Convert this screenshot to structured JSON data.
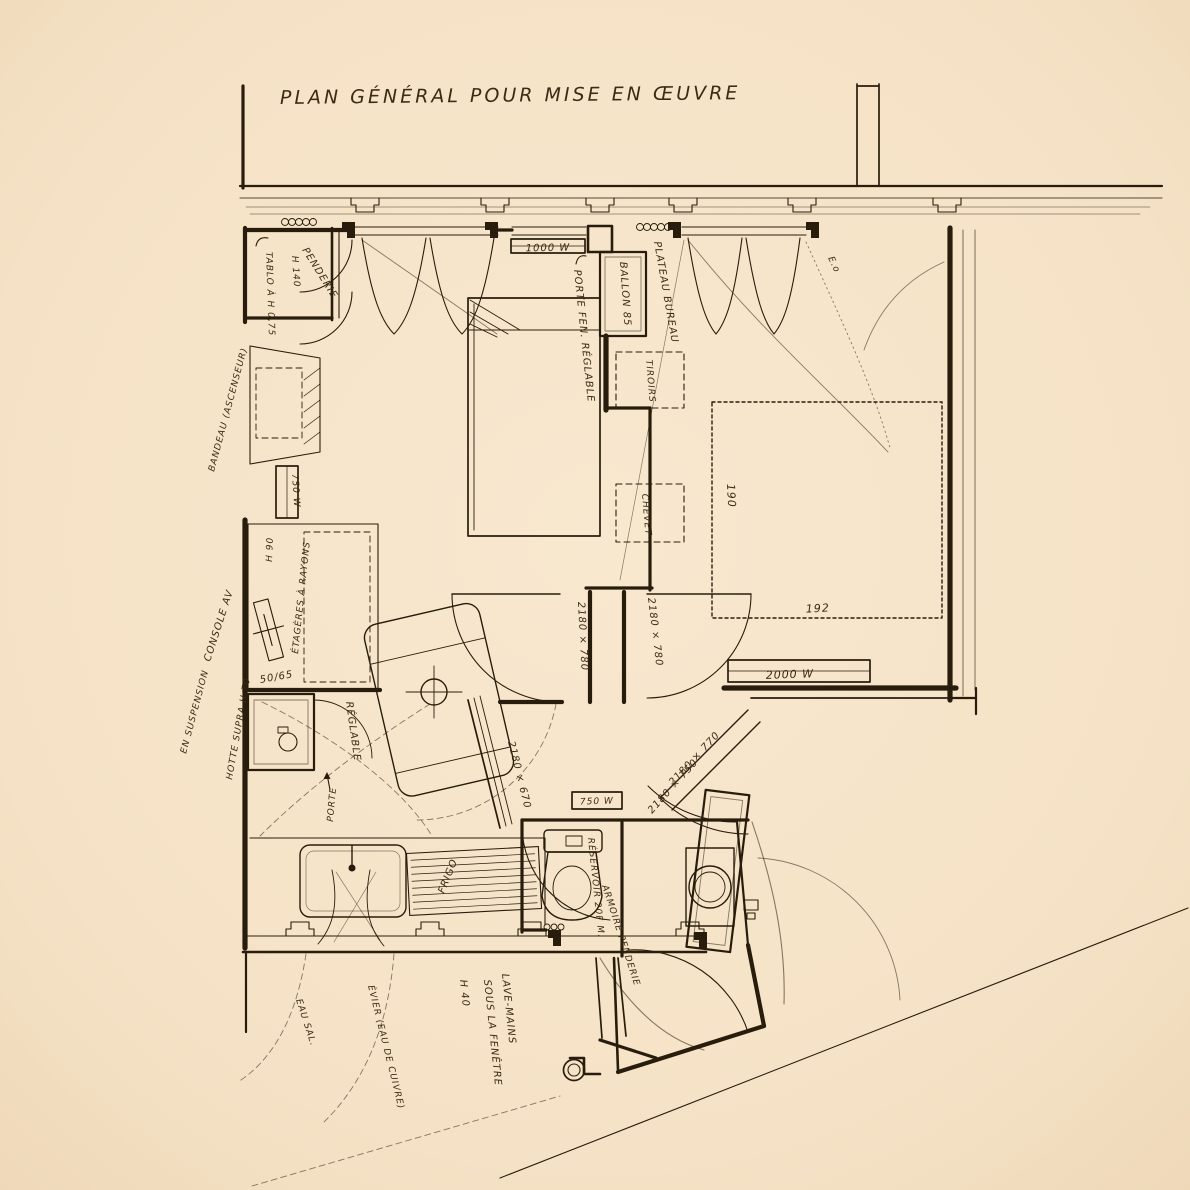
{
  "meta": {
    "drawing_type": "hand-drawn architectural floor plan",
    "paper_color": "#f6e4c9",
    "ink_color": "#281d0c"
  },
  "title": "PLAN GÉNÉRAL   POUR MISE EN ŒUVRE",
  "annotations": {
    "tablo": "TABLO À H 0,75",
    "h140": "H 140",
    "penderie": "PENDERIE",
    "radiator_living": "1000 W",
    "porte_fen": "PORTE FEN. RÉGLABLE",
    "ballon": "BALLON 85",
    "plateau_bureau": "PLATEAU BUREAU",
    "eo": "E.o",
    "tiroirs": "TIROIRS",
    "chevet": "CHEVET",
    "bed_width": "190",
    "bed_length": "192",
    "radiator_bedroom": "2000 W",
    "door_hall_left": "2180 × 780",
    "door_hall_right": "2180 × 780",
    "door_diag_1": "2180 × 770",
    "door_diag_2": "2180 × 750",
    "door_kitchen": "2180 × 670",
    "radiator_wc": "750 W",
    "radiator_left": "750 W",
    "reglable": "RÉGLABLE",
    "etageres": "ÉTAGÈRES À RAYONS",
    "h90": "H 90",
    "dim_50_65": "50/65",
    "console": "CONSOLE AV",
    "suspension": "EN SUSPENSION",
    "hotte": "HOTTE SUPRA H 70",
    "bandeau": "BANDEAU (ASCENSEUR)",
    "porte": "PORTE",
    "frigo": "FRIGO",
    "reservoir": "RÉSERVOIR 20F M.",
    "armoire": "ARMOIRE PENDERIE",
    "lave_mains_1": "LAVE-MAINS",
    "lave_mains_2": "SOUS LA FENÊTRE",
    "lave_mains_3": "H 40",
    "eau_sal": "EAU SAL.",
    "evier": "ÉVIER (EAU DE CUIVRE)"
  }
}
